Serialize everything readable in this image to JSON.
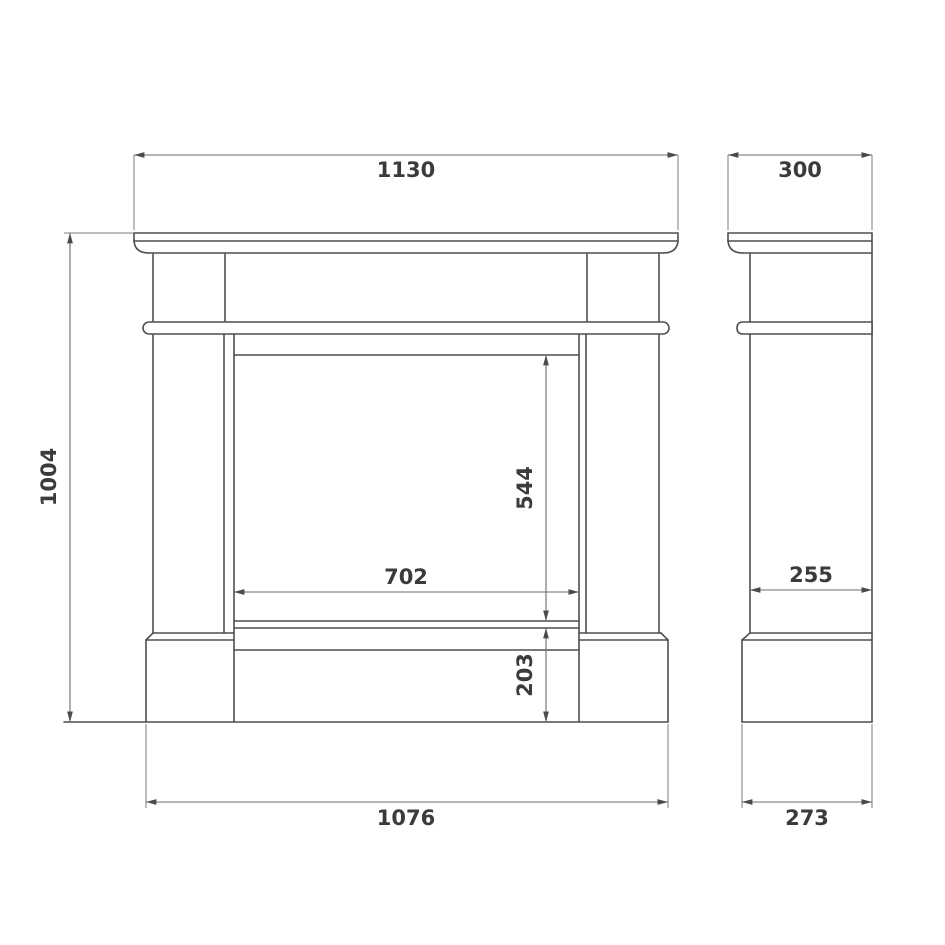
{
  "drawing": {
    "type": "technical-dimension-drawing",
    "subject": "fireplace mantel surround, front and side elevation",
    "units_shown": "mm (implied, unlabeled)",
    "colors": {
      "background": "#ffffff",
      "object_line": "#4f4f4f",
      "dimension_line": "#6b6b6b",
      "label_text": "#3b3b3b"
    }
  },
  "front_view": {
    "dims": {
      "shelf_width": "1130",
      "height": "1004",
      "opening_width": "702",
      "opening_height": "544",
      "hearth_height": "203",
      "base_width": "1076"
    }
  },
  "side_view": {
    "dims": {
      "shelf_depth": "300",
      "column_depth": "255",
      "base_depth": "273"
    }
  }
}
